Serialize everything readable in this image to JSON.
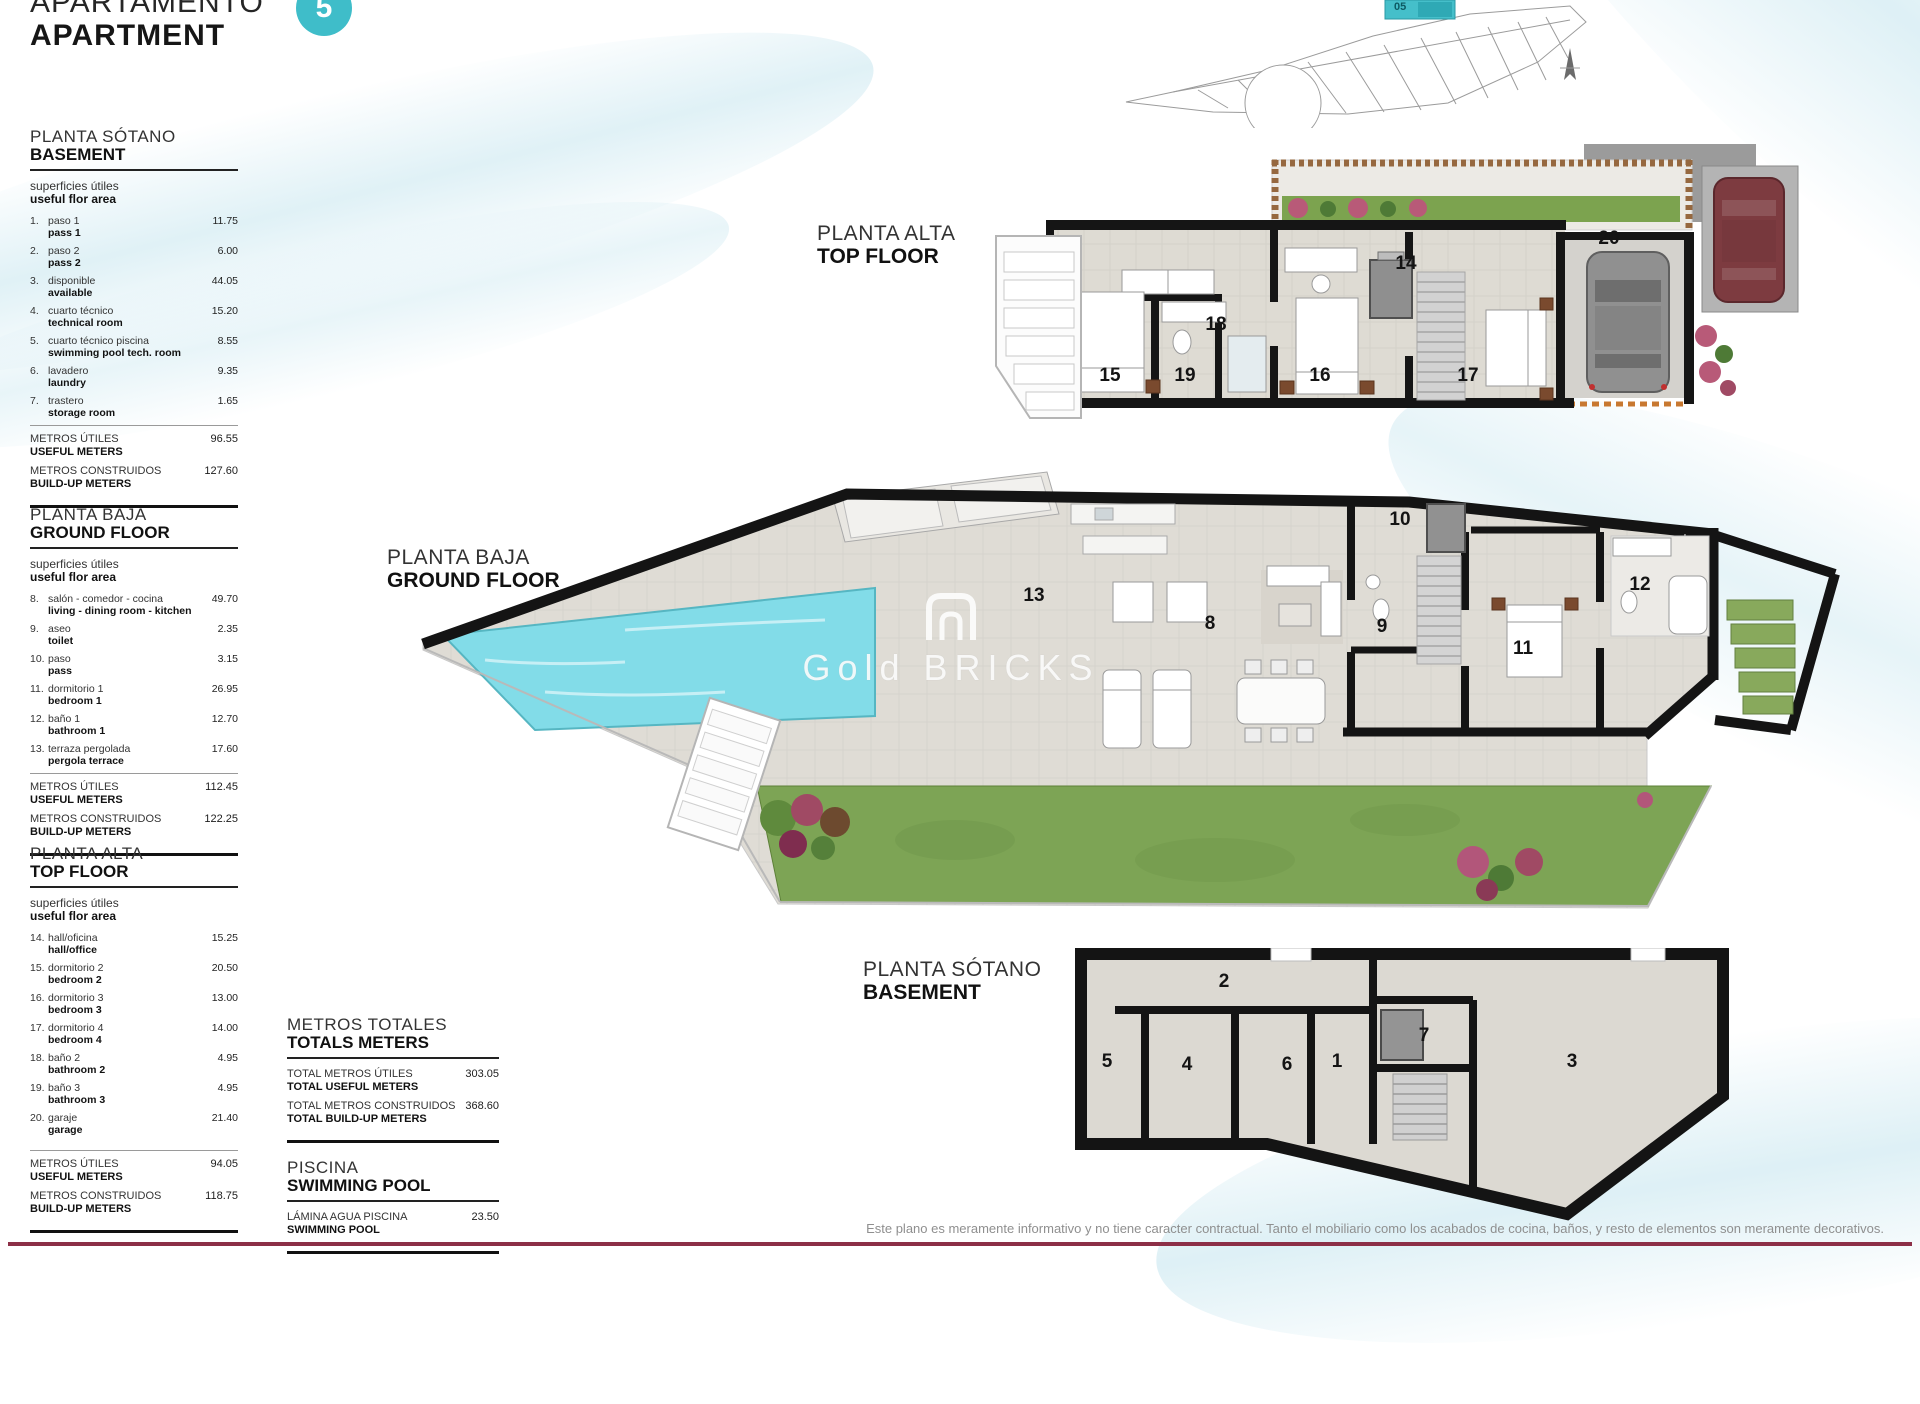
{
  "header": {
    "title_line1": "APARTAMENTO",
    "title_line2": "APARTMENT",
    "unit_badge": "5"
  },
  "site_plan": {
    "unit_label": "05"
  },
  "colors": {
    "accent_teal": "#3fbdc9",
    "pool_water": "#7fdbe6",
    "footer_line": "#8c2f47",
    "garden_green": "#7da455"
  },
  "area_sections": [
    {
      "title_es": "PLANTA SÓTANO",
      "title_en": "BASEMENT",
      "subtitle_es": "superficies útiles",
      "subtitle_en": "useful flor area",
      "items": [
        {
          "num": "1.",
          "es": "paso 1",
          "en": "pass 1",
          "value": "11.75"
        },
        {
          "num": "2.",
          "es": "paso 2",
          "en": "pass 2",
          "value": "6.00"
        },
        {
          "num": "3.",
          "es": "disponible",
          "en": "available",
          "value": "44.05"
        },
        {
          "num": "4.",
          "es": "cuarto técnico",
          "en": "technical room",
          "value": "15.20"
        },
        {
          "num": "5.",
          "es": "cuarto técnico piscina",
          "en": "swimming pool tech. room",
          "value": "8.55"
        },
        {
          "num": "6.",
          "es": "lavadero",
          "en": "laundry",
          "value": "9.35"
        },
        {
          "num": "7.",
          "es": "trastero",
          "en": "storage room",
          "value": "1.65"
        }
      ],
      "totals": [
        {
          "es": "METROS ÚTILES",
          "en": "USEFUL METERS",
          "value": "96.55"
        },
        {
          "es": "METROS CONSTRUIDOS",
          "en": "BUILD-UP METERS",
          "value": "127.60"
        }
      ]
    },
    {
      "title_es": "PLANTA BAJA",
      "title_en": "GROUND FLOOR",
      "subtitle_es": "superficies útiles",
      "subtitle_en": "useful flor area",
      "items": [
        {
          "num": "8.",
          "es": "salón - comedor - cocina",
          "en": "living - dining room - kitchen",
          "value": "49.70"
        },
        {
          "num": "9.",
          "es": "aseo",
          "en": "toilet",
          "value": "2.35"
        },
        {
          "num": "10.",
          "es": "paso",
          "en": "pass",
          "value": "3.15"
        },
        {
          "num": "11.",
          "es": "dormitorio 1",
          "en": "bedroom 1",
          "value": "26.95"
        },
        {
          "num": "12.",
          "es": "baño 1",
          "en": "bathroom 1",
          "value": "12.70"
        },
        {
          "num": "13.",
          "es": "terraza pergolada",
          "en": "pergola terrace",
          "value": "17.60"
        }
      ],
      "totals": [
        {
          "es": "METROS ÚTILES",
          "en": "USEFUL METERS",
          "value": "112.45"
        },
        {
          "es": "METROS CONSTRUIDOS",
          "en": "BUILD-UP METERS",
          "value": "122.25"
        }
      ]
    },
    {
      "title_es": "PLANTA ALTA",
      "title_en": "TOP FLOOR",
      "subtitle_es": "superficies útiles",
      "subtitle_en": "useful flor area",
      "items": [
        {
          "num": "14.",
          "es": "hall/oficina",
          "en": "hall/office",
          "value": "15.25"
        },
        {
          "num": "15.",
          "es": "dormitorio 2",
          "en": "bedroom 2",
          "value": "20.50"
        },
        {
          "num": "16.",
          "es": "dormitorio 3",
          "en": "bedroom 3",
          "value": "13.00"
        },
        {
          "num": "17.",
          "es": "dormitorio 4",
          "en": "bedroom 4",
          "value": "14.00"
        },
        {
          "num": "18.",
          "es": "baño 2",
          "en": "bathroom 2",
          "value": "4.95"
        },
        {
          "num": "19.",
          "es": "baño 3",
          "en": "bathroom 3",
          "value": "4.95"
        },
        {
          "num": "20.",
          "es": "garaje",
          "en": "garage",
          "value": "21.40"
        }
      ],
      "totals": [
        {
          "es": "METROS ÚTILES",
          "en": "USEFUL METERS",
          "value": "94.05"
        },
        {
          "es": "METROS CONSTRUIDOS",
          "en": "BUILD-UP METERS",
          "value": "118.75"
        }
      ]
    }
  ],
  "totals_section": {
    "title_es": "METROS TOTALES",
    "title_en": "TOTALS METERS",
    "rows": [
      {
        "es": "TOTAL METROS ÚTILES",
        "en": "TOTAL USEFUL METERS",
        "value": "303.05"
      },
      {
        "es": "TOTAL METROS CONSTRUIDOS",
        "en": "TOTAL BUILD-UP METERS",
        "value": "368.60"
      }
    ]
  },
  "pool_section": {
    "title_es": "PISCINA",
    "title_en": "SWIMMING POOL",
    "rows": [
      {
        "es": "LÁMINA AGUA PISCINA",
        "en": "SWIMMING POOL",
        "value": "23.50"
      }
    ]
  },
  "plans": {
    "top_floor": {
      "label_es": "PLANTA ALTA",
      "label_en": "TOP FLOOR",
      "rooms": [
        "14",
        "18",
        "15",
        "19",
        "16",
        "17",
        "20"
      ]
    },
    "ground_floor": {
      "label_es": "PLANTA BAJA",
      "label_en": "GROUND FLOOR",
      "rooms": [
        "13",
        "8",
        "9",
        "10",
        "11",
        "12"
      ]
    },
    "basement": {
      "label_es": "PLANTA SÓTANO",
      "label_en": "BASEMENT",
      "rooms": [
        "2",
        "5",
        "4",
        "6",
        "1",
        "7",
        "3"
      ]
    }
  },
  "watermark": {
    "word1": "Gold",
    "word2": "BRICKS"
  },
  "footer": {
    "disclaimer": "Este plano es meramente informativo y no tiene caracter contractual. Tanto el mobiliario como los acabados de cocina, baños, y resto de elementos son meramente decorativos."
  }
}
